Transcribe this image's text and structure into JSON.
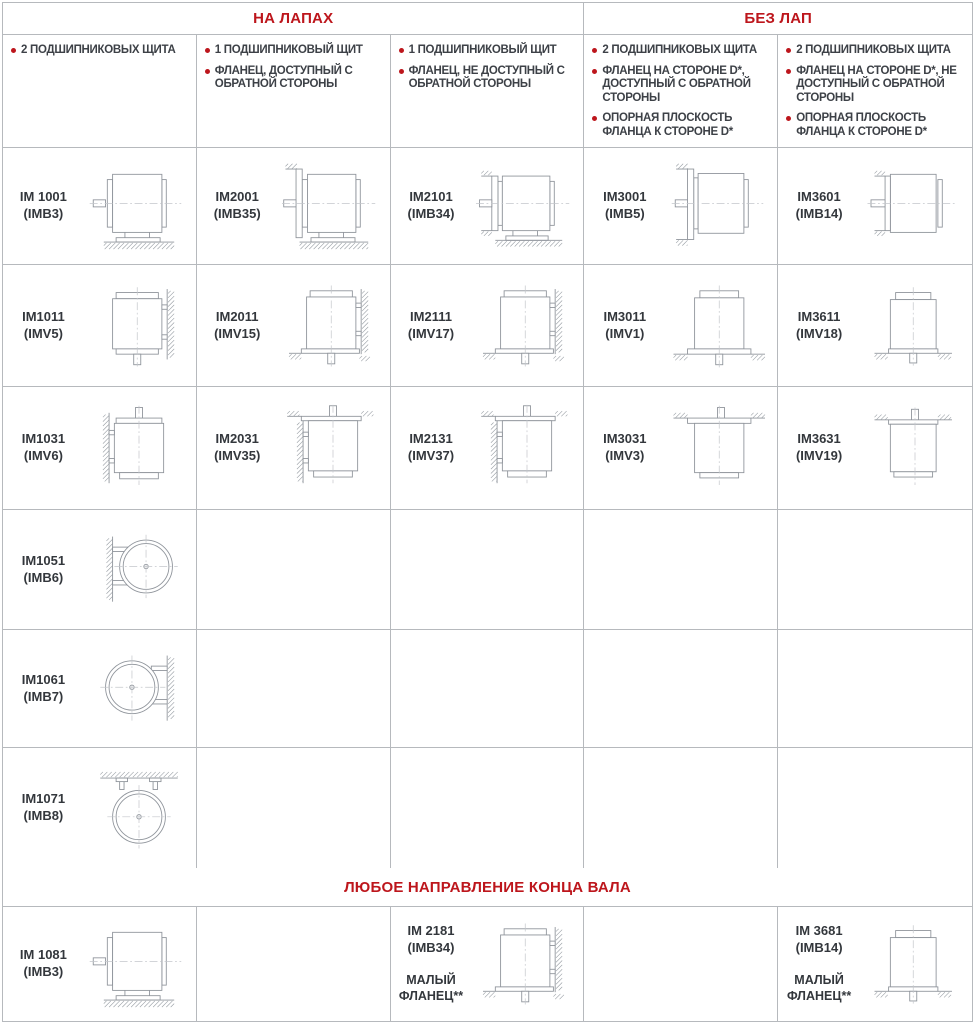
{
  "colors": {
    "accent_red": "#bd161c",
    "grid_line": "#b6b9bd",
    "diagram_stroke": "#8f949b",
    "hatch": "#9aa0a6",
    "text_dark": "#3d4147",
    "label_dark": "#33373c"
  },
  "headers": {
    "on_feet": "НА ЛАПАХ",
    "without_feet": "БЕЗ ЛАП",
    "any_direction": "ЛЮБОЕ НАПРАВЛЕНИЕ КОНЦА ВАЛА"
  },
  "column_descriptions": [
    {
      "bullets": [
        "2 ПОДШИПНИКОВЫХ ЩИТА"
      ]
    },
    {
      "bullets": [
        "1 ПОДШИПНИКОВЫЙ ЩИТ",
        "ФЛАНЕЦ, ДОСТУПНЫЙ С ОБРАТНОЙ СТОРОНЫ"
      ]
    },
    {
      "bullets": [
        "1 ПОДШИПНИКОВЫЙ ЩИТ",
        "ФЛАНЕЦ, НЕ ДОСТУПНЫЙ С ОБРАТНОЙ СТОРОНЫ"
      ]
    },
    {
      "bullets": [
        "2 ПОДШИПНИКОВЫХ ЩИТА",
        "ФЛАНЕЦ НА СТОРОНЕ D*, ДОСТУПНЫЙ С ОБРАТНОЙ СТОРОНЫ",
        "ОПОРНАЯ ПЛОСКОСТЬ ФЛАНЦА К СТОРОНЕ D*"
      ]
    },
    {
      "bullets": [
        "2 ПОДШИПНИКОВЫХ ЩИТА",
        "ФЛАНЕЦ НА СТОРОНЕ D*, НЕ ДОСТУПНЫЙ С ОБРАТНОЙ СТОРОНЫ",
        "ОПОРНАЯ ПЛОСКОСТЬ ФЛАНЦА К СТОРОНЕ D*"
      ]
    }
  ],
  "rows": [
    [
      {
        "code": "IM 1001",
        "alt": "(IMB3)",
        "diagram": "h-feet"
      },
      {
        "code": "IM2001",
        "alt": "(IMB35)",
        "diagram": "h-feet-flange"
      },
      {
        "code": "IM2101",
        "alt": "(IMB34)",
        "diagram": "h-feet-flange-small"
      },
      {
        "code": "IM3001",
        "alt": "(IMB5)",
        "diagram": "h-flange"
      },
      {
        "code": "IM3601",
        "alt": "(IMB14)",
        "diagram": "h-flange-small"
      }
    ],
    [
      {
        "code": "IM1011",
        "alt": "(IMV5)",
        "diagram": "v-down-wall"
      },
      {
        "code": "IM2011",
        "alt": "(IMV15)",
        "diagram": "v-down-wall-flange"
      },
      {
        "code": "IM2111",
        "alt": "(IMV17)",
        "diagram": "v-down-wall-flange"
      },
      {
        "code": "IM3011",
        "alt": "(IMV1)",
        "diagram": "v-down-flange"
      },
      {
        "code": "IM3611",
        "alt": "(IMV18)",
        "diagram": "v-down-flange-small"
      }
    ],
    [
      {
        "code": "IM1031",
        "alt": "(IMV6)",
        "diagram": "v-up-wall"
      },
      {
        "code": "IM2031",
        "alt": "(IMV35)",
        "diagram": "v-up-wall-flange"
      },
      {
        "code": "IM2131",
        "alt": "(IMV37)",
        "diagram": "v-up-wall-flange"
      },
      {
        "code": "IM3031",
        "alt": "(IMV3)",
        "diagram": "v-up-flange"
      },
      {
        "code": "IM3631",
        "alt": "(IMV19)",
        "diagram": "v-up-flange-small"
      }
    ],
    [
      {
        "code": "IM1051",
        "alt": "(IMB6)",
        "diagram": "end-wall-left"
      },
      null,
      null,
      null,
      null
    ],
    [
      {
        "code": "IM1061",
        "alt": "(IMB7)",
        "diagram": "end-wall-right"
      },
      null,
      null,
      null,
      null
    ],
    [
      {
        "code": "IM1071",
        "alt": "(IMB8)",
        "diagram": "end-ceiling"
      },
      null,
      null,
      null,
      null
    ]
  ],
  "bottom_row": [
    {
      "code": "IM 1081",
      "alt": "(IMB3)",
      "diagram": "h-feet"
    },
    null,
    {
      "code": "IM 2181",
      "alt": "(IMB34)",
      "note": "МАЛЫЙ ФЛАНЕЦ**",
      "diagram": "v-down-wall-flange"
    },
    null,
    {
      "code": "IM 3681",
      "alt": "(IMB14)",
      "note": "МАЛЫЙ ФЛАНЕЦ**",
      "diagram": "v-down-flange-small"
    }
  ]
}
